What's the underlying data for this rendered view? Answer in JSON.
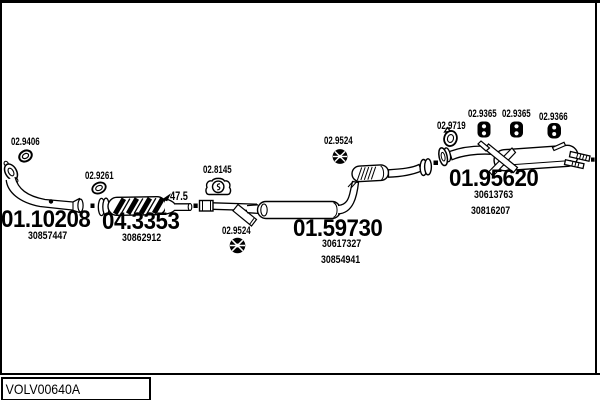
{
  "diagram": {
    "reference": "VOLV00640A",
    "dimension_47_5": "47.5",
    "sections": [
      {
        "code": "01.10208",
        "oem": [
          "30857447"
        ]
      },
      {
        "code": "04.3353",
        "oem": [
          "30862912"
        ]
      },
      {
        "code": "01.59730",
        "oem": [
          "30617327",
          "30854941"
        ]
      },
      {
        "code": "01.95620",
        "oem": [
          "30613763",
          "30816207"
        ]
      }
    ],
    "fittings": [
      {
        "code": "02.9406",
        "icon": "flange-gasket-ring"
      },
      {
        "code": "02.9261",
        "icon": "ring-gasket"
      },
      {
        "code": "02.8145",
        "icon": "rubber-hanger-bracket"
      },
      {
        "code": "02.9524",
        "icon": "round-rubber-mount"
      },
      {
        "code": "02.9524",
        "icon": "round-rubber-mount"
      },
      {
        "code": "02.9719",
        "icon": "exhaust-gasket-ring"
      },
      {
        "code": "02.9365",
        "icon": "rubber-hanger-block"
      },
      {
        "code": "02.9365",
        "icon": "rubber-hanger-block"
      },
      {
        "code": "02.9366",
        "icon": "rubber-hanger-block"
      }
    ],
    "colors": {
      "line": "#000000",
      "background": "#ffffff"
    }
  }
}
